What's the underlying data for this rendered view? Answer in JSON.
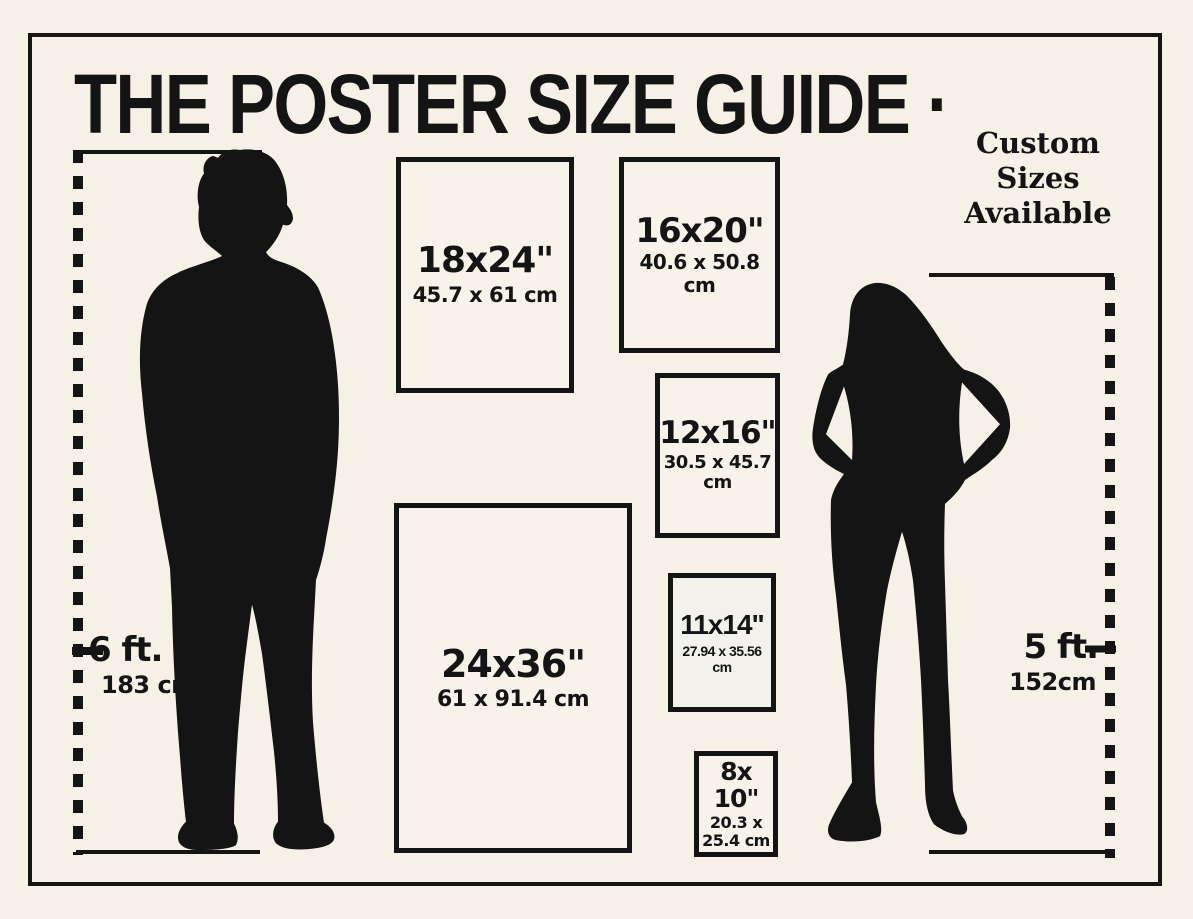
{
  "colors": {
    "background": "#f6f1e6",
    "ink": "#141414",
    "box_fill": "#f7f3ea"
  },
  "header": {
    "title": "THE POSTER SIZE GUIDE ·",
    "custom_note": {
      "line1": "Custom",
      "line2": "Sizes",
      "line3": "Available"
    }
  },
  "figures": {
    "man": {
      "height_ft": "6 ft.",
      "height_cm": "183 cm"
    },
    "woman": {
      "height_ft": "5 ft.",
      "height_cm": "152cm"
    }
  },
  "posters": [
    {
      "size_in": "18x24\"",
      "size_cm": "45.7 x 61 cm"
    },
    {
      "size_in": "16x20\"",
      "size_cm": "40.6 x 50.8 cm"
    },
    {
      "size_in": "12x16\"",
      "size_cm": "30.5 x 45.7 cm"
    },
    {
      "size_in": "11x14\"",
      "size_cm": "27.94 x 35.56 cm"
    },
    {
      "size_in": "24x36\"",
      "size_cm": "61 x 91.4 cm"
    },
    {
      "size_in_line1": "8x",
      "size_in_line2": "10\"",
      "size_cm_line1": "20.3 x",
      "size_cm_line2": "25.4 cm"
    }
  ]
}
